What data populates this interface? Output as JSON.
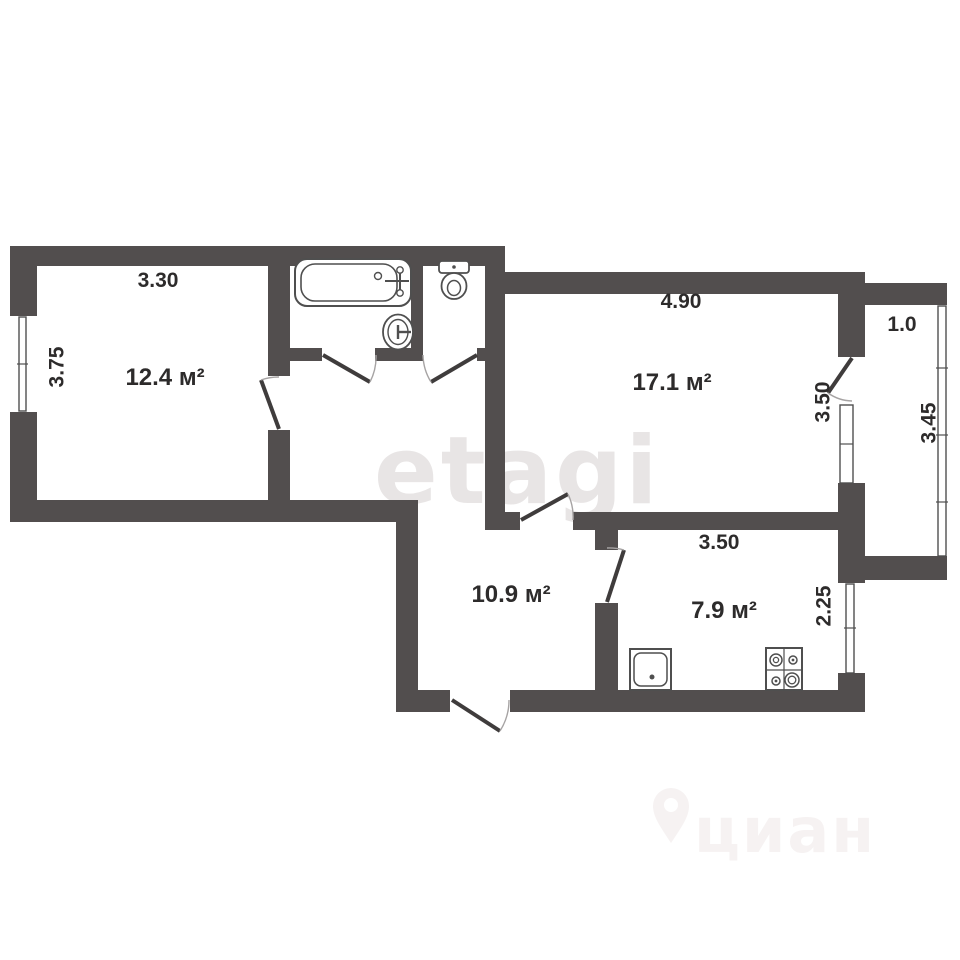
{
  "plan": {
    "type": "apartment floor plan",
    "watermark_center": "etagi",
    "watermark_bottom": "циан",
    "rooms": [
      {
        "name": "room-12-4",
        "area": "12.4 м²",
        "width_m": "3.30",
        "depth_m": "3.75"
      },
      {
        "name": "room-17-1",
        "area": "17.1 м²",
        "width_m": "4.90",
        "depth_m": "3.50"
      },
      {
        "name": "hallway",
        "area": "10.9 м²"
      },
      {
        "name": "kitchen",
        "area": "7.9 м²",
        "width_m": "3.50",
        "depth_m": "2.25"
      },
      {
        "name": "balcony",
        "width_m": "1.0",
        "depth_m": "3.45"
      }
    ],
    "fixtures": [
      "bathtub",
      "toilet",
      "bathroom-sink",
      "kitchen-sink",
      "stove"
    ]
  },
  "colors": {
    "background": "#ffffff",
    "wall": "#524e4e",
    "door_line": "#3f3c3c",
    "fixture_line": "#4f4f4f",
    "arc": "#a6a3a3",
    "label": "#2d2b2b",
    "watermark_etagi": "#e8e5e5",
    "watermark_cian": "#f6f2f2"
  }
}
